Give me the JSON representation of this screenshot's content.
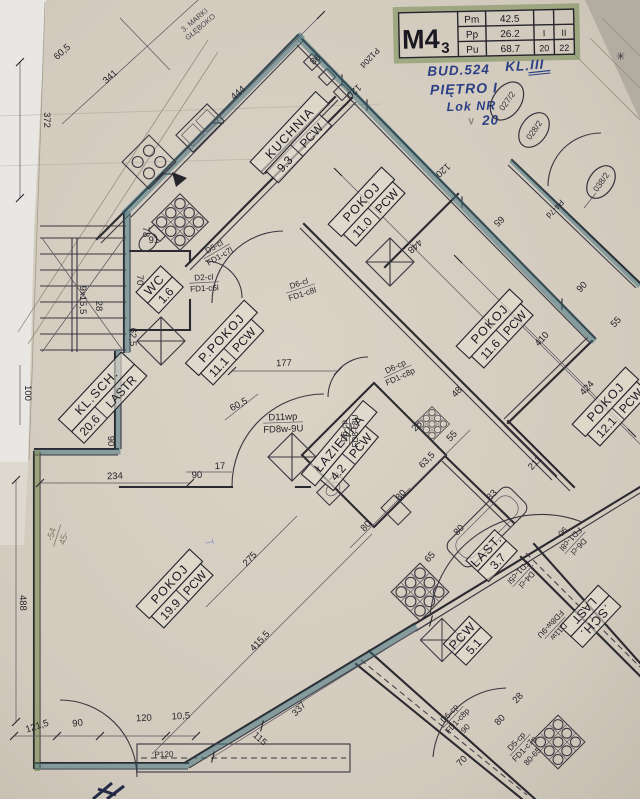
{
  "colors": {
    "paper": "#d5cec2",
    "teal": "#3f6f7a",
    "olive": "#6f8047",
    "marker_green": "#7b9059",
    "ink_blue": "#2b3f85"
  },
  "title_block": {
    "model": "M4",
    "model_sub": "3",
    "rows": [
      {
        "key": "Pm",
        "value": "42.5",
        "col1": "",
        "col2": ""
      },
      {
        "key": "Pp",
        "value": "26.2",
        "col1": "I",
        "col2": "II"
      },
      {
        "key": "Pu",
        "value": "68.7",
        "col1": "20",
        "col2": "22"
      }
    ]
  },
  "handwriting": {
    "line1": "BUD.524",
    "line1b": "KL.",
    "line1c": "III",
    "line2": "PIĘTRO I",
    "line3": "Lok NR",
    "line3b": "20",
    "check": "∨",
    "star": "✳"
  },
  "stamps": {
    "c1": "027/2",
    "c2": "028/2",
    "c3": "038/2"
  },
  "margin_note": {
    "a": "3. MARKI",
    "b": "GŁĘBOKO"
  },
  "pencil_notes": {
    "frac_top": "-54",
    "frac_bottom": "45-",
    "t_mark": "T"
  },
  "rooms": {
    "kuchnia": {
      "name": "KUCHNIA",
      "area": "9.3",
      "floor": "PCW"
    },
    "pokoj_a": {
      "name": "POKOJ",
      "area": "11.0",
      "floor": "PCW"
    },
    "pokoj_b": {
      "name": "POKOJ",
      "area": "11.6",
      "floor": "PCW"
    },
    "ppokoj": {
      "name": "P.POKOJ",
      "area": "11.1",
      "floor": "PCW"
    },
    "wc": {
      "name": "WC",
      "area": "1.6",
      "floor": ""
    },
    "klsch": {
      "name": "KL.SCH.",
      "area": "20.6",
      "floor": "LASTR"
    },
    "lazienka": {
      "name": "ŁAZIENKA",
      "area": "4.2",
      "floor": "PCW"
    },
    "pokoj_c": {
      "name": "POKOJ",
      "area": "19.9",
      "floor": "PCW"
    },
    "pokoj_d": {
      "name": "POKOJ",
      "area": "12.1",
      "floor": "PCW"
    },
    "last": {
      "name": "LAST.",
      "area": "3.7",
      "floor": ""
    },
    "pcw51": {
      "name": "PCW",
      "area": "5.1",
      "floor": ""
    },
    "schlast_fragment": {
      "a": ".SCH.",
      "b": "LAST"
    }
  },
  "doors": [
    {
      "l1": "D5-cl",
      "l2": "FD1-c7l",
      "extra": ""
    },
    {
      "l1": "D2-cl",
      "l2": "FD1-c6l",
      "extra": ""
    },
    {
      "l1": "D6-cl",
      "l2": "FD1-c8l",
      "extra": ""
    },
    {
      "l1": "D6-cp",
      "l2": "FD1-c8p",
      "extra": ""
    },
    {
      "l1": "D6-cp",
      "l2": "FD8-c8U",
      "extra": ""
    },
    {
      "l1": "D11wp",
      "l2": "FD8w-9U",
      "extra": ""
    },
    {
      "l1": "D6-cl",
      "l2": "FD1-c8l",
      "extra": "90"
    },
    {
      "l1": "D11w",
      "l2": "FD8w-9U",
      "extra": ""
    },
    {
      "l1": "D6-cp",
      "l2": "FD1-c8p",
      "extra": "90"
    },
    {
      "l1": "D5-cp",
      "l2": "FD1-c7p",
      "extra": "80-65"
    },
    {
      "l1": "D4-cl",
      "l2": "FD1-c5l",
      "extra": ""
    }
  ],
  "windows": [
    {
      "label": "P120d"
    },
    {
      "label": "P4-7d"
    },
    {
      "label": "P120"
    }
  ],
  "dims": [
    {
      "t": "444"
    },
    {
      "t": "98"
    },
    {
      "t": "120"
    },
    {
      "t": "448"
    },
    {
      "t": "120"
    },
    {
      "t": "65"
    },
    {
      "t": "410"
    },
    {
      "t": "424"
    },
    {
      "t": "90"
    },
    {
      "t": "55"
    },
    {
      "t": "48"
    },
    {
      "t": "211"
    },
    {
      "t": "372"
    },
    {
      "t": "341"
    },
    {
      "t": "60,5"
    },
    {
      "t": "9x15,5"
    },
    {
      "t": "28"
    },
    {
      "t": "100"
    },
    {
      "t": "62,5"
    },
    {
      "t": "70"
    },
    {
      "t": "91"
    },
    {
      "t": "78"
    },
    {
      "t": "234"
    },
    {
      "t": "90"
    },
    {
      "t": "177"
    },
    {
      "t": "60,5"
    },
    {
      "t": "17"
    },
    {
      "t": "90"
    },
    {
      "t": "80"
    },
    {
      "t": "80"
    },
    {
      "t": "63,5"
    },
    {
      "t": "55"
    },
    {
      "t": "25"
    },
    {
      "t": "488"
    },
    {
      "t": "121,5"
    },
    {
      "t": "90"
    },
    {
      "t": "120"
    },
    {
      "t": "10,5"
    },
    {
      "t": "115"
    },
    {
      "t": "337"
    },
    {
      "t": "275"
    },
    {
      "t": "415,5"
    },
    {
      "t": "28"
    },
    {
      "t": "80"
    },
    {
      "t": "70"
    },
    {
      "t": "83"
    },
    {
      "t": "80"
    },
    {
      "t": "65"
    }
  ]
}
